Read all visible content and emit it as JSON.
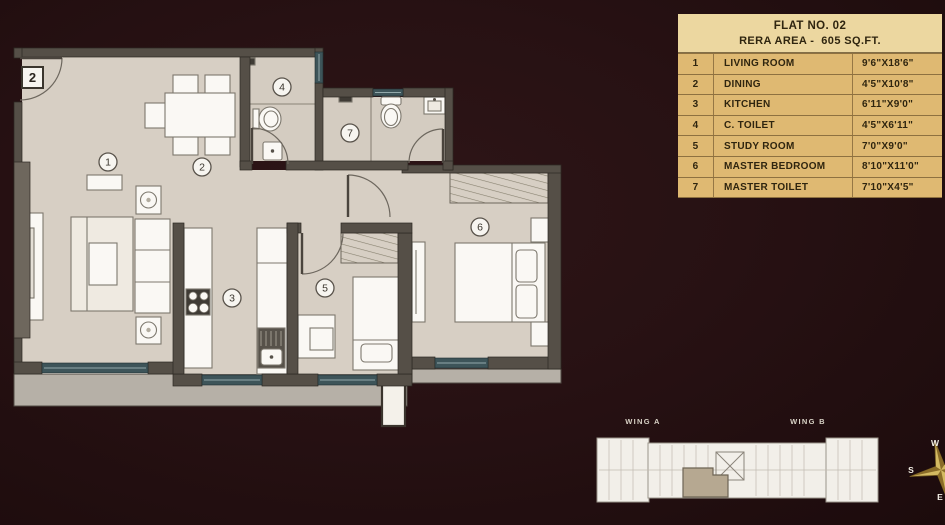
{
  "legend_table": {
    "title": "FLAT NO. 02",
    "subtitle": "RERA AREA -  605 SQ.FT.",
    "rows": [
      {
        "no": "1",
        "name": "LIVING ROOM",
        "size": "9'6\"X18'6\""
      },
      {
        "no": "2",
        "name": "DINING",
        "size": "4'5\"X10'8\""
      },
      {
        "no": "3",
        "name": "KITCHEN",
        "size": "6'11\"X9'0\""
      },
      {
        "no": "4",
        "name": "C. TOILET",
        "size": "4'5\"X6'11\""
      },
      {
        "no": "5",
        "name": "STUDY ROOM",
        "size": "7'0\"X9'0\""
      },
      {
        "no": "6",
        "name": "MASTER BEDROOM",
        "size": "8'10\"X11'0\""
      },
      {
        "no": "7",
        "name": "MASTER TOILET",
        "size": "7'10\"X4'5\""
      }
    ]
  },
  "plan": {
    "flat_marker": "2",
    "markers": [
      "1",
      "2",
      "3",
      "4",
      "5",
      "6",
      "7"
    ]
  },
  "key_plan": {
    "wing_a": "WING A",
    "wing_b": "WING B"
  },
  "compass": {
    "west": "W",
    "south": "S",
    "east": "E"
  },
  "colors": {
    "background": "#271113",
    "table_header_bg": "#ecd7a0",
    "table_row_bg": "#dfb972",
    "floor": "#d7cfc4",
    "wall": "#554f47",
    "window": "#3d5459",
    "ledge": "#b6b0a7",
    "compass_gold": "#d4ba62"
  }
}
